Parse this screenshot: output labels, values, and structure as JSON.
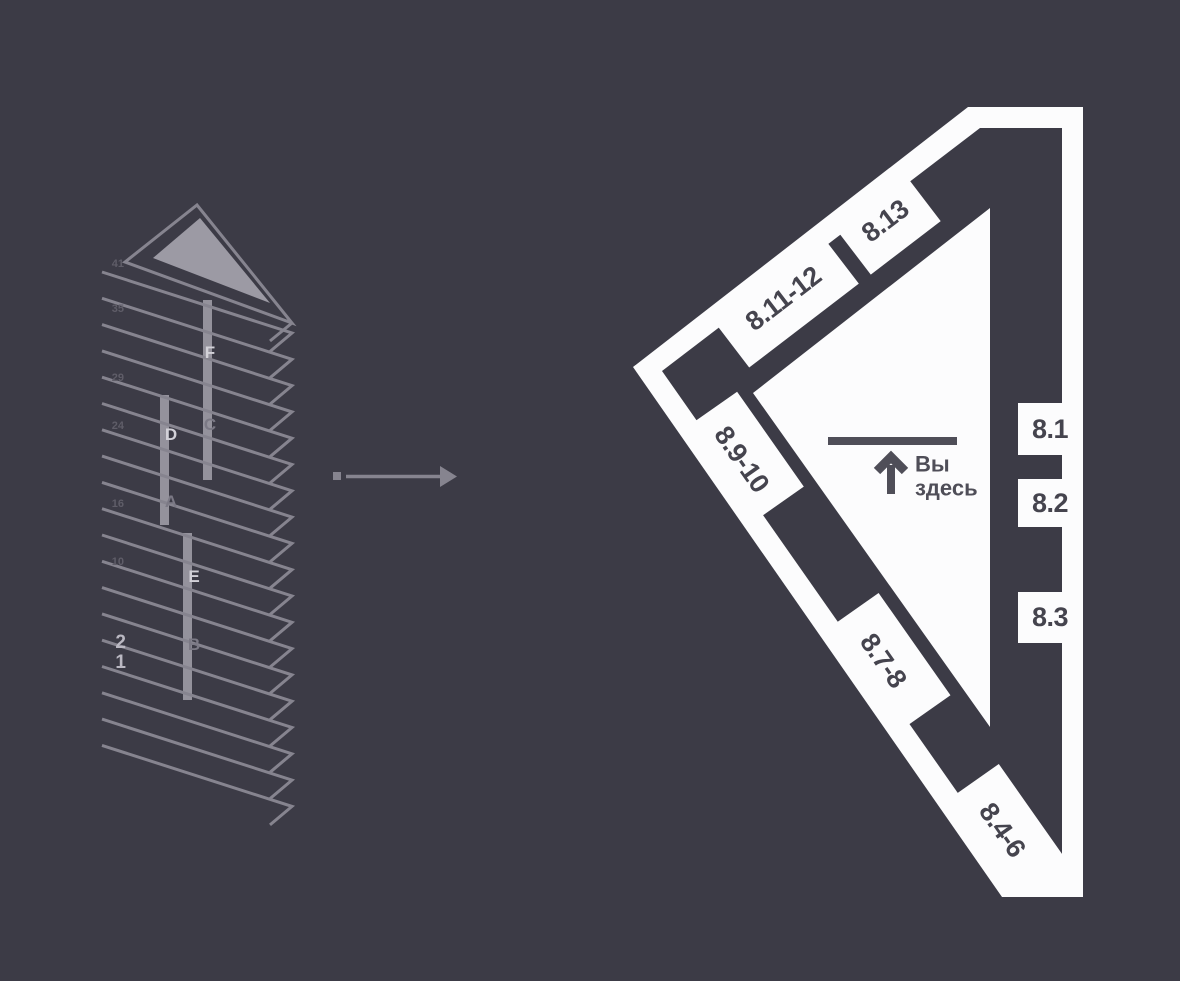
{
  "colors": {
    "background": "#3c3b46",
    "line_gray": "#86848f",
    "triangle_fill": "#9c9aa4",
    "bar_fill": "#9c9aa4",
    "letter_bright": "#d2d1d8",
    "letter_dim": "#7b7985",
    "number_bright": "#bab8c2",
    "number_dim": "#5f5d68",
    "plan_white": "#fcfcfd",
    "plan_dark": "#3c3b46",
    "unit_label": "#45444e",
    "marker_gray": "#4f4e58"
  },
  "building": {
    "floor_numbers": [
      "41",
      "35",
      "29",
      "24",
      "16",
      "10",
      "2",
      "1"
    ],
    "riser_labels": [
      "F",
      "C",
      "D",
      "A",
      "E",
      "B"
    ]
  },
  "plan": {
    "units": {
      "top": [
        "8.11-12",
        "8.13"
      ],
      "right": [
        "8.1",
        "8.2",
        "8.3"
      ],
      "bottom": [
        "8.9-10",
        "8.7-8",
        "8.4-6"
      ]
    },
    "you_are_here": {
      "line1": "Вы",
      "line2": "здесь"
    }
  }
}
